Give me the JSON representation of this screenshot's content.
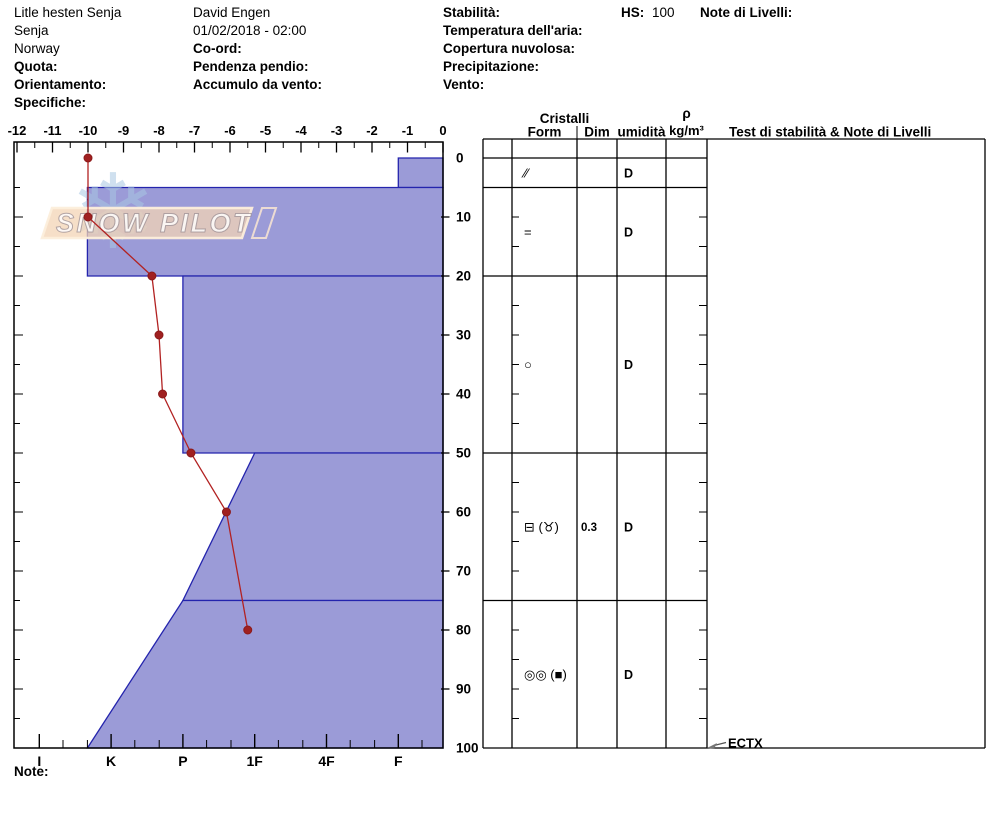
{
  "header": {
    "location": [
      "Litle hesten Senja",
      "Senja",
      "Norway",
      "Quota:",
      "Orientamento:",
      "Specifiche:"
    ],
    "observer": [
      "David Engen",
      "01/02/2018 - 02:00",
      "Co-ord:",
      "Pendenza pendio:",
      "Accumulo da vento:"
    ],
    "conditions": [
      "Stabilità:",
      "Temperatura dell'aria:",
      "Copertura nuvolosa:",
      "Precipitazione:",
      "Vento:"
    ],
    "hs_label": "HS:",
    "hs_value": "100",
    "level_notes_label": "Note di Livelli:"
  },
  "watermark": {
    "text": "SNOW PILOT",
    "snowflake_icon": "❄"
  },
  "chart_data": {
    "type": "snow-profile",
    "temperature_axis": {
      "range": [
        -12,
        0
      ],
      "tick_step": 1,
      "minor_tick_step": 0.5,
      "unit": "°C"
    },
    "depth_axis": {
      "range": [
        0,
        100
      ],
      "tick_step": 10,
      "minor_tick_step": 5,
      "unit": "cm"
    },
    "hardness_axis": {
      "categories": [
        "F",
        "4F",
        "1F",
        "P",
        "K",
        "I"
      ],
      "minor_steps_per_category": 3
    },
    "temperature_profile": {
      "depths_cm": [
        0,
        10,
        20,
        30,
        40,
        50,
        60,
        80
      ],
      "temps_c": [
        -10,
        -10,
        -8.2,
        -8.0,
        -7.9,
        -7.1,
        -6.1,
        -5.5
      ]
    },
    "layers": [
      {
        "top_cm": 0,
        "bottom_cm": 5,
        "hardness": "F",
        "hardness_top_code": 1,
        "hardness_bottom_code": 1
      },
      {
        "top_cm": 5,
        "bottom_cm": 20,
        "hardness": "K+",
        "hardness_top_code": 5.33,
        "hardness_bottom_code": 5.33
      },
      {
        "top_cm": 20,
        "bottom_cm": 50,
        "hardness": "P",
        "hardness_top_code": 4,
        "hardness_bottom_code": 4
      },
      {
        "top_cm": 50,
        "bottom_cm": 75,
        "hardness": "1F-P",
        "hardness_top_code": 3,
        "hardness_bottom_code": 4
      },
      {
        "top_cm": 75,
        "bottom_cm": 100,
        "hardness": "P-K+",
        "hardness_top_code": 4,
        "hardness_bottom_code": 5.33
      }
    ],
    "colors": {
      "layer_fill": "#9b9bd7",
      "layer_border": "#2424ad",
      "temp_line": "#b22222",
      "temp_point": "#a02020",
      "axis": "#000000"
    }
  },
  "table": {
    "crystals_header": "Cristalli",
    "col_form": "Form",
    "col_dim": "Dim",
    "col_humidity": "umidità",
    "density_header_rho": "ρ",
    "density_header_unit": "kg/m³",
    "stability_header": "Test di stabilità & Note di Livelli",
    "rows": [
      {
        "top_cm": 0,
        "bottom_cm": 5,
        "form": "⁄⁄",
        "dim": "",
        "humidity": "D"
      },
      {
        "top_cm": 5,
        "bottom_cm": 20,
        "form": "=",
        "dim": "",
        "humidity": "D"
      },
      {
        "top_cm": 20,
        "bottom_cm": 50,
        "form": "○",
        "dim": "",
        "humidity": "D"
      },
      {
        "top_cm": 50,
        "bottom_cm": 75,
        "form": "⊟ (♉)",
        "dim": "0.3",
        "humidity": "D"
      },
      {
        "top_cm": 75,
        "bottom_cm": 100,
        "form": "◎◎ (■)",
        "dim": "",
        "humidity": "D"
      }
    ],
    "stability_tests": [
      {
        "result": "ECTX",
        "depth_cm": 100
      }
    ]
  },
  "note_label": "Note:"
}
